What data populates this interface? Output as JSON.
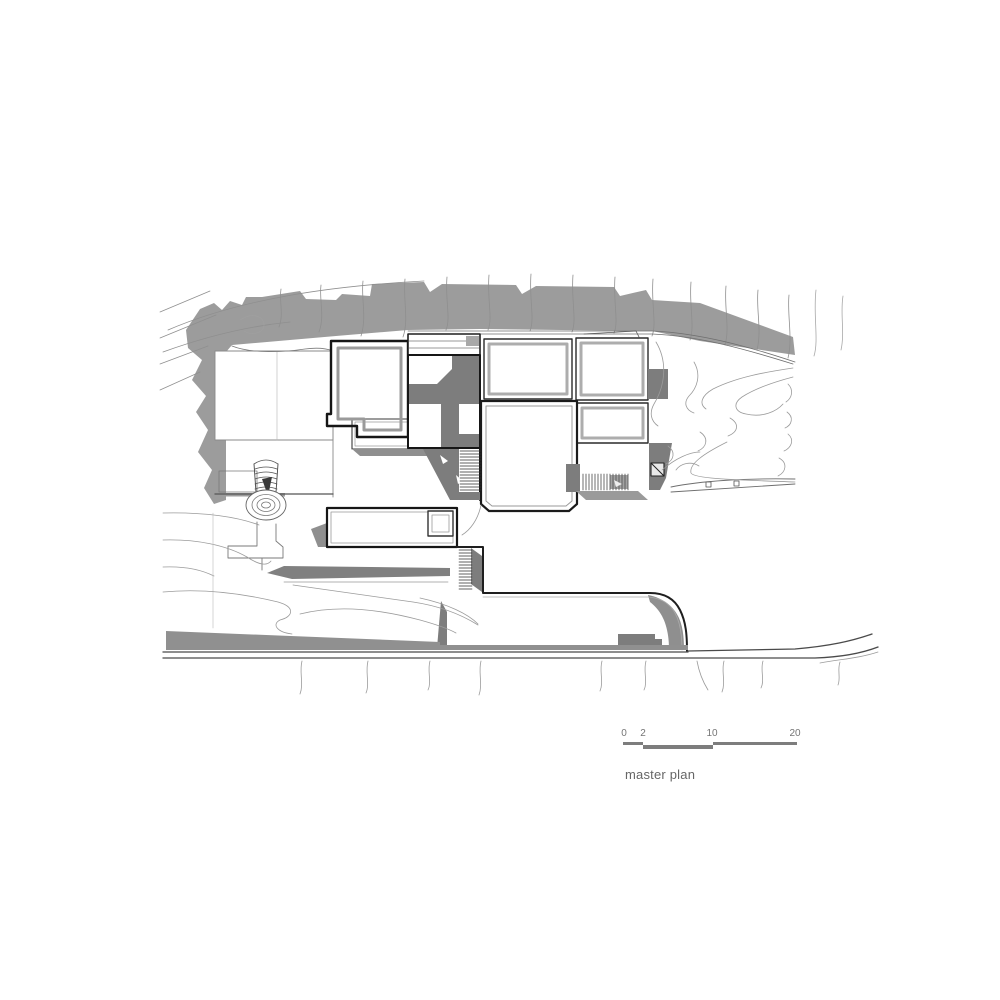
{
  "canvas": {
    "background": "#ffffff"
  },
  "drawing": {
    "kind": "architectural site plan",
    "elements": [
      "terrain contour lines",
      "hillside shadow",
      "building roofs",
      "courtyard",
      "stairs",
      "spiral stair",
      "pool terrace",
      "driveway with rounded corner",
      "road",
      "parked car"
    ]
  },
  "scale_bar": {
    "labels": [
      "0",
      "2",
      "10",
      "20"
    ],
    "bar_color": "#7d7d7d",
    "text_color": "#757575"
  },
  "caption": {
    "text": "master plan",
    "color": "#666666"
  },
  "palette": {
    "shadow_gray": "#9c9c9c",
    "dark_gray": "#7d7d7d",
    "road_gray": "#909090",
    "contour_gray": "#999999",
    "outline_black": "#1a1a1a"
  }
}
